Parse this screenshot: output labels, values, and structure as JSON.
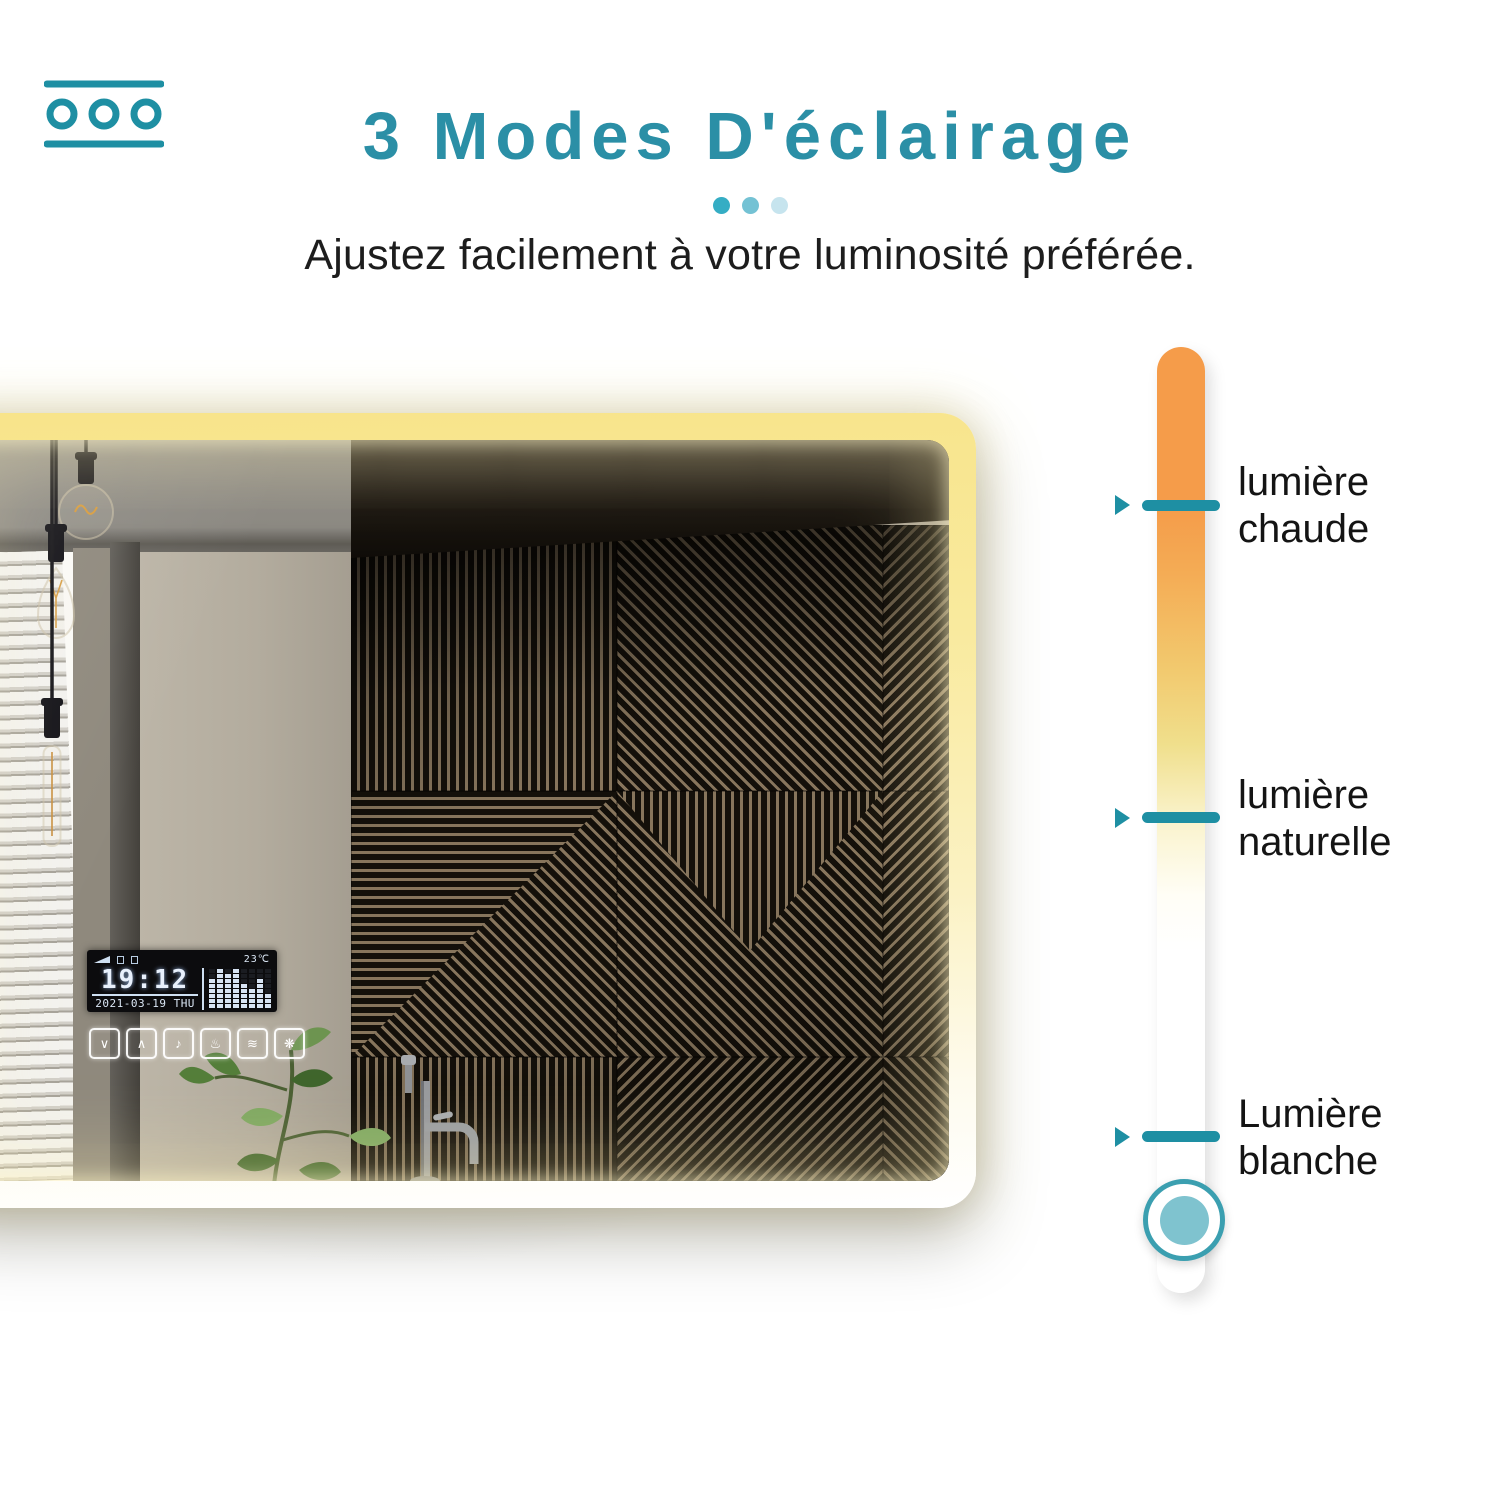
{
  "header": {
    "brand_icon": "dimmer-circles-icon",
    "title": "3 Modes D'éclairage",
    "title_color": "#2B8FA6",
    "dot_colors": [
      "#35ADC4",
      "#74C2D4",
      "#C6E4EE"
    ],
    "subtitle": "Ajustez facilement à votre luminosité préférée."
  },
  "mirror": {
    "description": "backlit-led-bathroom-mirror-photo",
    "led_glow_colors": [
      "#F8E48A",
      "#FFFFFF"
    ],
    "display": {
      "time": "19:12",
      "date": "2021-03-19 THU",
      "temperature": "23℃",
      "spectrum_levels": [
        6,
        8,
        7,
        8,
        5,
        4,
        6,
        3
      ],
      "status_icons": [
        "signal-icon",
        "mute-icon",
        "battery-icon"
      ]
    },
    "touch_controls": [
      {
        "name": "chevron-down-icon",
        "glyph": "∨"
      },
      {
        "name": "chevron-up-icon",
        "glyph": "∧"
      },
      {
        "name": "music-note-icon",
        "glyph": "♪"
      },
      {
        "name": "steam-icon",
        "glyph": "♨"
      },
      {
        "name": "defog-icon",
        "glyph": "≋"
      },
      {
        "name": "snowflake-icon",
        "glyph": "❋"
      }
    ]
  },
  "slider": {
    "tick_color": "#1E8FA3",
    "gradient": [
      "#F59C4A",
      "#F2C96E",
      "#F0DF8C",
      "#FAF3CC",
      "#FFFFFF"
    ],
    "modes": [
      {
        "line1": "lumière",
        "line2": "chaude"
      },
      {
        "line1": "lumière",
        "line2": "naturelle"
      },
      {
        "line1": "Lumière",
        "line2": "blanche"
      }
    ],
    "knob": {
      "ring_color": "#3B9FB0",
      "fill_color": "#7FC3CF"
    }
  }
}
